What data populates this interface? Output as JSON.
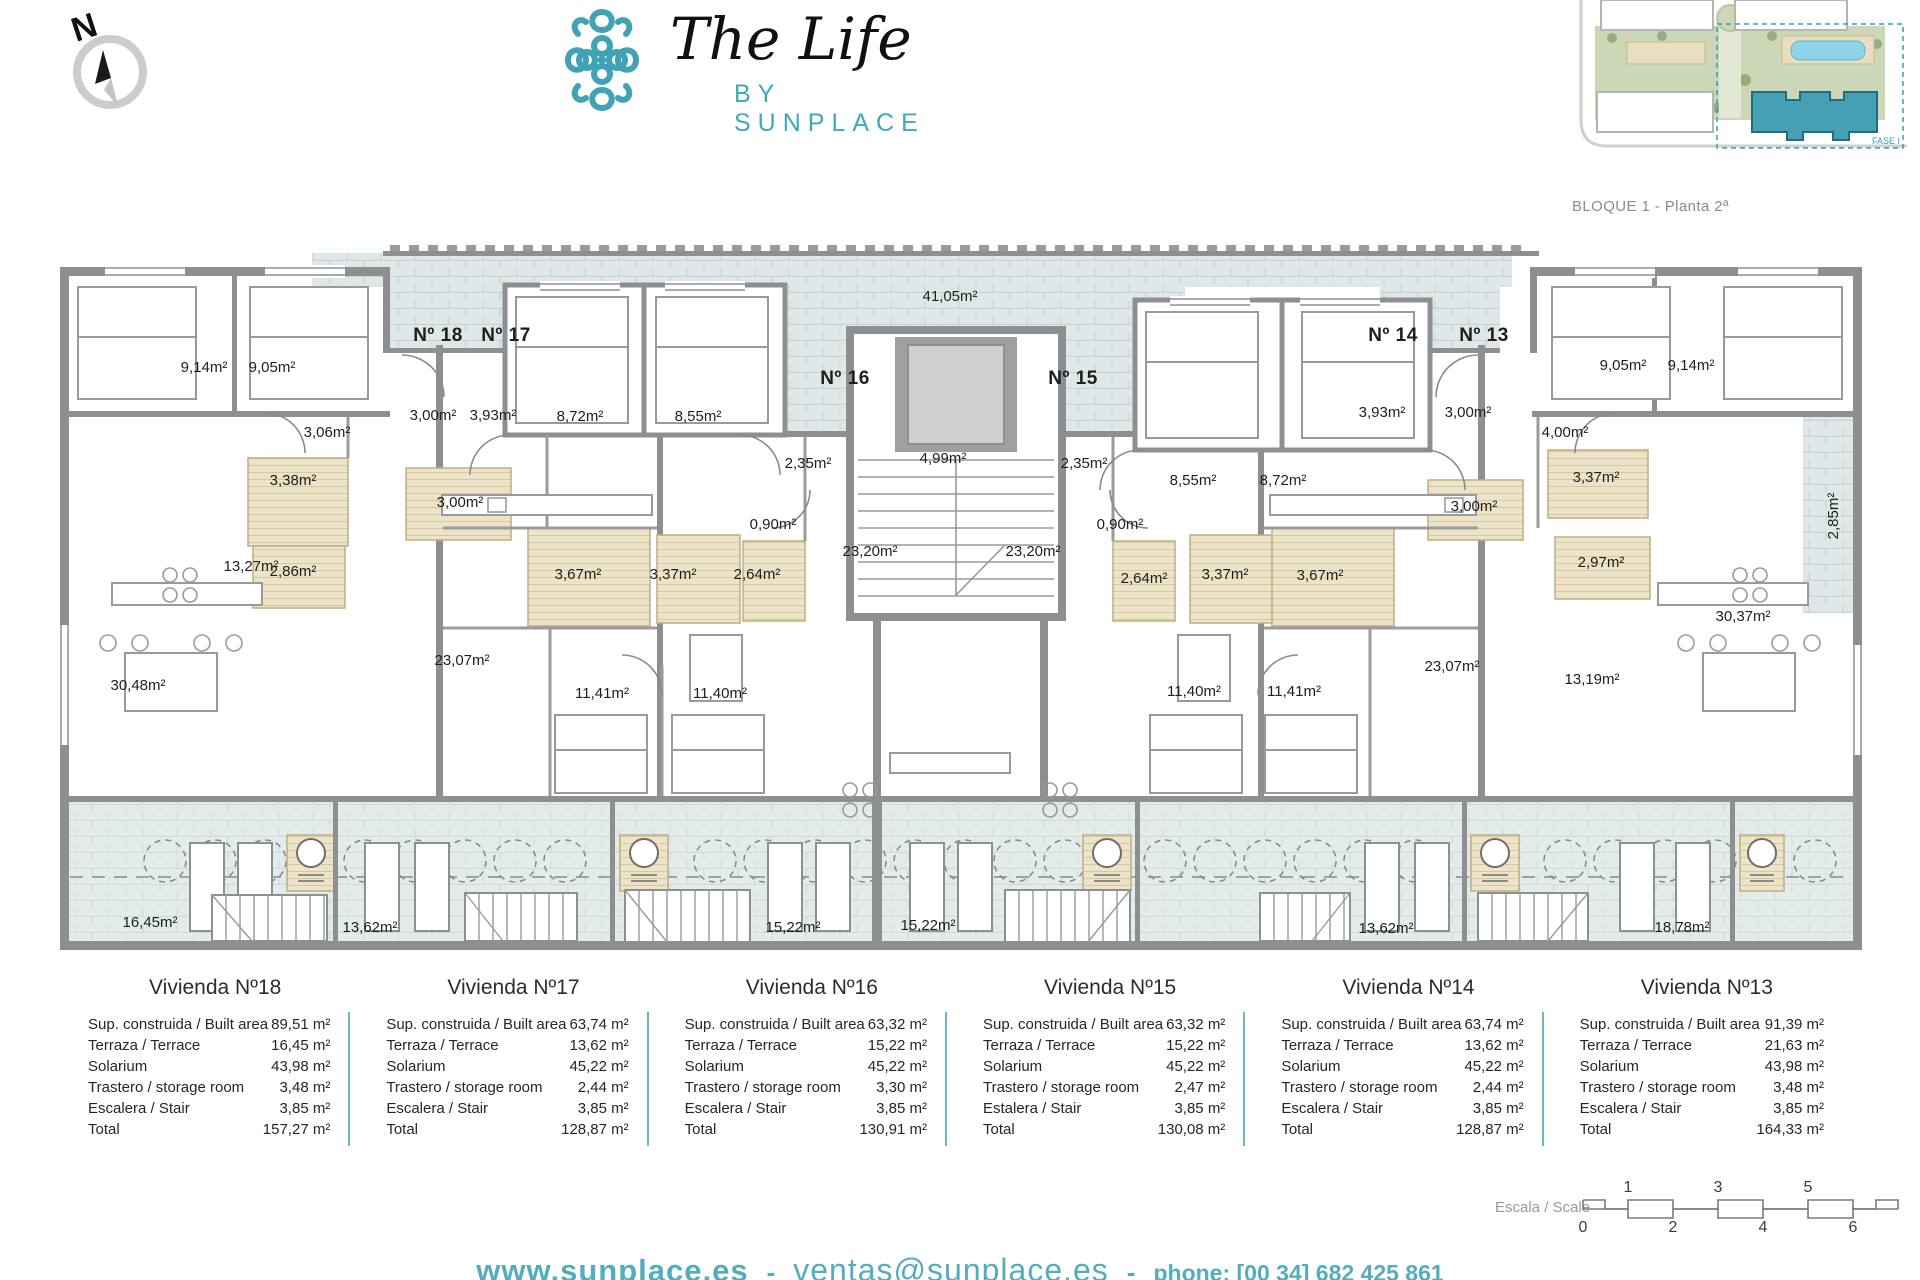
{
  "brand": {
    "title": "The Life",
    "subtitle": "BY SUNPLACE",
    "accent": "#3fa3b3"
  },
  "compass": {
    "label": "N"
  },
  "siteplan": {
    "caption": "BLOQUE 1 - Planta 2ª",
    "fase_label": "FASE I"
  },
  "plan": {
    "terrace_top_label": "41,05m²",
    "apartments": [
      {
        "label": "Nº 18",
        "x": 388,
        "y": 96
      },
      {
        "label": "Nº 17",
        "x": 456,
        "y": 96
      },
      {
        "label": "Nº 16",
        "x": 795,
        "y": 139
      },
      {
        "label": "Nº 15",
        "x": 1023,
        "y": 139
      },
      {
        "label": "Nº 14",
        "x": 1343,
        "y": 96
      },
      {
        "label": "Nº 13",
        "x": 1434,
        "y": 96
      }
    ],
    "rooms": [
      {
        "label": "41,05m²",
        "x": 900,
        "y": 56
      },
      {
        "label": "9,14m²",
        "x": 154,
        "y": 127
      },
      {
        "label": "9,05m²",
        "x": 222,
        "y": 127
      },
      {
        "label": "3,06m²",
        "x": 277,
        "y": 192
      },
      {
        "label": "3,00m²",
        "x": 383,
        "y": 175
      },
      {
        "label": "3,93m²",
        "x": 443,
        "y": 175
      },
      {
        "label": "8,72m²",
        "x": 530,
        "y": 176
      },
      {
        "label": "8,55m²",
        "x": 648,
        "y": 176
      },
      {
        "label": "2,35m²",
        "x": 758,
        "y": 223
      },
      {
        "label": "4,99m²",
        "x": 893,
        "y": 218
      },
      {
        "label": "2,35m²",
        "x": 1034,
        "y": 223
      },
      {
        "label": "3,38m²",
        "x": 243,
        "y": 240
      },
      {
        "label": "3,00m²",
        "x": 410,
        "y": 262
      },
      {
        "label": "2,86m²",
        "x": 243,
        "y": 331
      },
      {
        "label": "3,67m²",
        "x": 528,
        "y": 334
      },
      {
        "label": "3,37m²",
        "x": 623,
        "y": 334
      },
      {
        "label": "2,64m²",
        "x": 707,
        "y": 334
      },
      {
        "label": "0,90m²",
        "x": 723,
        "y": 284
      },
      {
        "label": "23,20m²",
        "x": 820,
        "y": 311
      },
      {
        "label": "23,20m²",
        "x": 983,
        "y": 311
      },
      {
        "label": "0,90m²",
        "x": 1070,
        "y": 284
      },
      {
        "label": "8,55m²",
        "x": 1143,
        "y": 240
      },
      {
        "label": "8,72m²",
        "x": 1233,
        "y": 240
      },
      {
        "label": "3,93m²",
        "x": 1332,
        "y": 172
      },
      {
        "label": "3,00m²",
        "x": 1418,
        "y": 172
      },
      {
        "label": "4,00m²",
        "x": 1515,
        "y": 192
      },
      {
        "label": "9,05m²",
        "x": 1573,
        "y": 125
      },
      {
        "label": "9,14m²",
        "x": 1641,
        "y": 125
      },
      {
        "label": "2,64m²",
        "x": 1094,
        "y": 338
      },
      {
        "label": "3,37m²",
        "x": 1175,
        "y": 334
      },
      {
        "label": "3,67m²",
        "x": 1270,
        "y": 335
      },
      {
        "label": "3,00m²",
        "x": 1424,
        "y": 266
      },
      {
        "label": "3,37m²",
        "x": 1546,
        "y": 237
      },
      {
        "label": "2,97m²",
        "x": 1551,
        "y": 322
      },
      {
        "label": "2,85m²",
        "x": 1788,
        "y": 271,
        "rot": -90
      },
      {
        "label": "30,48m²",
        "x": 88,
        "y": 445
      },
      {
        "label": "13,27m²",
        "x": 201,
        "y": 326
      },
      {
        "label": "23,07m²",
        "x": 412,
        "y": 420
      },
      {
        "label": "11,41m²",
        "x": 552,
        "y": 453
      },
      {
        "label": "11,40m²",
        "x": 670,
        "y": 453
      },
      {
        "label": "11,40m²",
        "x": 1144,
        "y": 451
      },
      {
        "label": "11,41m²",
        "x": 1244,
        "y": 451
      },
      {
        "label": "23,07m²",
        "x": 1402,
        "y": 426
      },
      {
        "label": "13,19m²",
        "x": 1542,
        "y": 439
      },
      {
        "label": "30,37m²",
        "x": 1693,
        "y": 376
      },
      {
        "label": "16,45m²",
        "x": 100,
        "y": 682
      },
      {
        "label": "13,62m²",
        "x": 320,
        "y": 687
      },
      {
        "label": "15,22m²",
        "x": 743,
        "y": 687
      },
      {
        "label": "15,22m²",
        "x": 878,
        "y": 685
      },
      {
        "label": "13,62m²",
        "x": 1336,
        "y": 688
      },
      {
        "label": "18,78m²",
        "x": 1632,
        "y": 687
      }
    ]
  },
  "tables": {
    "items": [
      {
        "title": "Vivienda Nº18",
        "rows": [
          [
            "Sup. construida / Built area",
            "89,51 m²"
          ],
          [
            "Terraza / Terrace",
            "16,45 m²"
          ],
          [
            "Solarium",
            "43,98 m²"
          ],
          [
            "Trastero / storage room",
            "3,48 m²"
          ],
          [
            "Escalera / Stair",
            "3,85 m²"
          ],
          [
            "Total",
            "157,27 m²"
          ]
        ]
      },
      {
        "title": "Vivienda Nº17",
        "rows": [
          [
            "Sup. construida / Built area",
            "63,74 m²"
          ],
          [
            "Terraza / Terrace",
            "13,62 m²"
          ],
          [
            "Solarium",
            "45,22 m²"
          ],
          [
            "Trastero / storage room",
            "2,44 m²"
          ],
          [
            "Escalera / Stair",
            "3,85 m²"
          ],
          [
            "Total",
            "128,87 m²"
          ]
        ]
      },
      {
        "title": "Vivienda Nº16",
        "rows": [
          [
            "Sup. construida / Built area",
            "63,32 m²"
          ],
          [
            "Terraza / Terrace",
            "15,22 m²"
          ],
          [
            "Solarium",
            "45,22 m²"
          ],
          [
            "Trastero / storage room",
            "3,30 m²"
          ],
          [
            "Escalera / Stair",
            "3,85 m²"
          ],
          [
            "Total",
            "130,91 m²"
          ]
        ]
      },
      {
        "title": "Vivienda Nº15",
        "rows": [
          [
            "Sup. construida / Built area",
            "63,32 m²"
          ],
          [
            "Terraza / Terrace",
            "15,22 m²"
          ],
          [
            "Solarium",
            "45,22 m²"
          ],
          [
            "Trastero / storage room",
            "2,47 m²"
          ],
          [
            "Estalera / Stair",
            "3,85 m²"
          ],
          [
            "Total",
            "130,08 m²"
          ]
        ]
      },
      {
        "title": "Vivienda Nº14",
        "rows": [
          [
            "Sup. construida / Built area",
            "63,74 m²"
          ],
          [
            "Terraza / Terrace",
            "13,62 m²"
          ],
          [
            "Solarium",
            "45,22 m²"
          ],
          [
            "Trastero / storage room",
            "2,44 m²"
          ],
          [
            "Escalera / Stair",
            "3,85 m²"
          ],
          [
            "Total",
            "128,87 m²"
          ]
        ]
      },
      {
        "title": "Vivienda Nº13",
        "rows": [
          [
            "Sup. construida / Built area",
            "91,39 m²"
          ],
          [
            "Terraza / Terrace",
            "21,63 m²"
          ],
          [
            "Solarium",
            "43,98 m²"
          ],
          [
            "Trastero / storage room",
            "3,48 m²"
          ],
          [
            "Escalera / Stair",
            "3,85 m²"
          ],
          [
            "Total",
            "164,33 m²"
          ]
        ]
      }
    ]
  },
  "scalebar": {
    "label": "Escala / Scale",
    "top_numbers": [
      "1",
      "3",
      "5"
    ],
    "bottom_numbers": [
      "0",
      "2",
      "4",
      "6"
    ]
  },
  "footer": {
    "website": "www.sunplace.es",
    "separator": "-",
    "email": "ventas@sunplace.es",
    "phone": "phone: [00 34]  682 425 861"
  }
}
